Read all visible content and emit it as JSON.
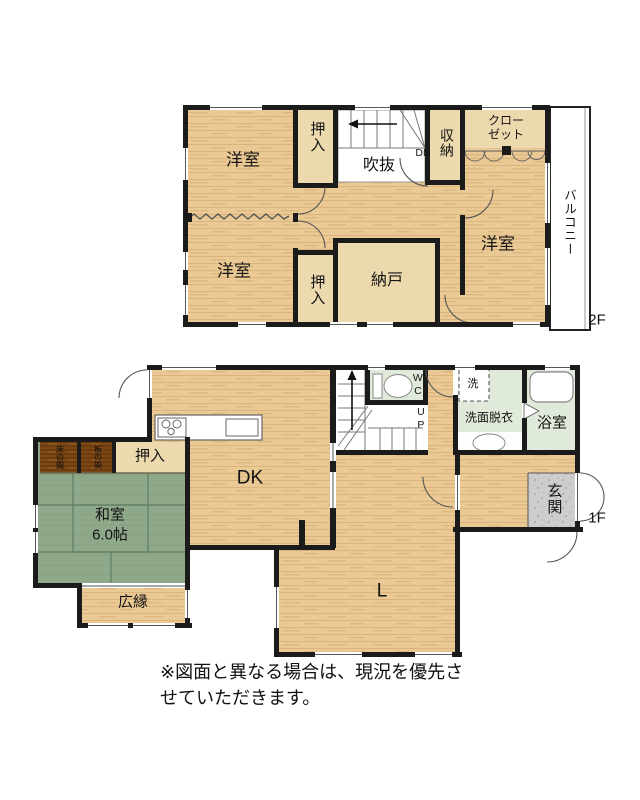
{
  "floor2": {
    "floor_label": "2F",
    "yoshitsu_nw": "洋室",
    "yoshitsu_sw": "洋室",
    "yoshitsu_e": "洋室",
    "oshiire_top": "押入",
    "oshiire_bottom": "押入",
    "fukinuke": "吹抜",
    "dn": "DN",
    "shuno": "収納",
    "closet_line1": "クロー",
    "closet_line2": "ゼット",
    "nando": "納戸",
    "balcony": "バルコニー"
  },
  "floor1": {
    "floor_label": "1F",
    "dk": "DK",
    "living": "L",
    "washitsu": "和室",
    "washitsu_size": "6.0帖",
    "oshiire": "押入",
    "tokonoma": "床の間",
    "itanoma": "板の間",
    "hiroen": "広縁",
    "wc": "WC",
    "up": "UP",
    "washer": "洗",
    "senmendatsui": "洗面脱衣",
    "yokushitsu": "浴室",
    "genkan": "玄関"
  },
  "caption": "※図面と異なる場合は、現況を優先させていただきます。",
  "colors": {
    "wood_floor": "#eac994",
    "tatami_green": "#8fa88a",
    "alcove_brown": "#7c4716",
    "wet_area_green": "#e0eadb",
    "closet_beige": "#ecd9ae",
    "genkan_gray": "#cdcdcd",
    "wall_black": "#1b1b1b"
  }
}
